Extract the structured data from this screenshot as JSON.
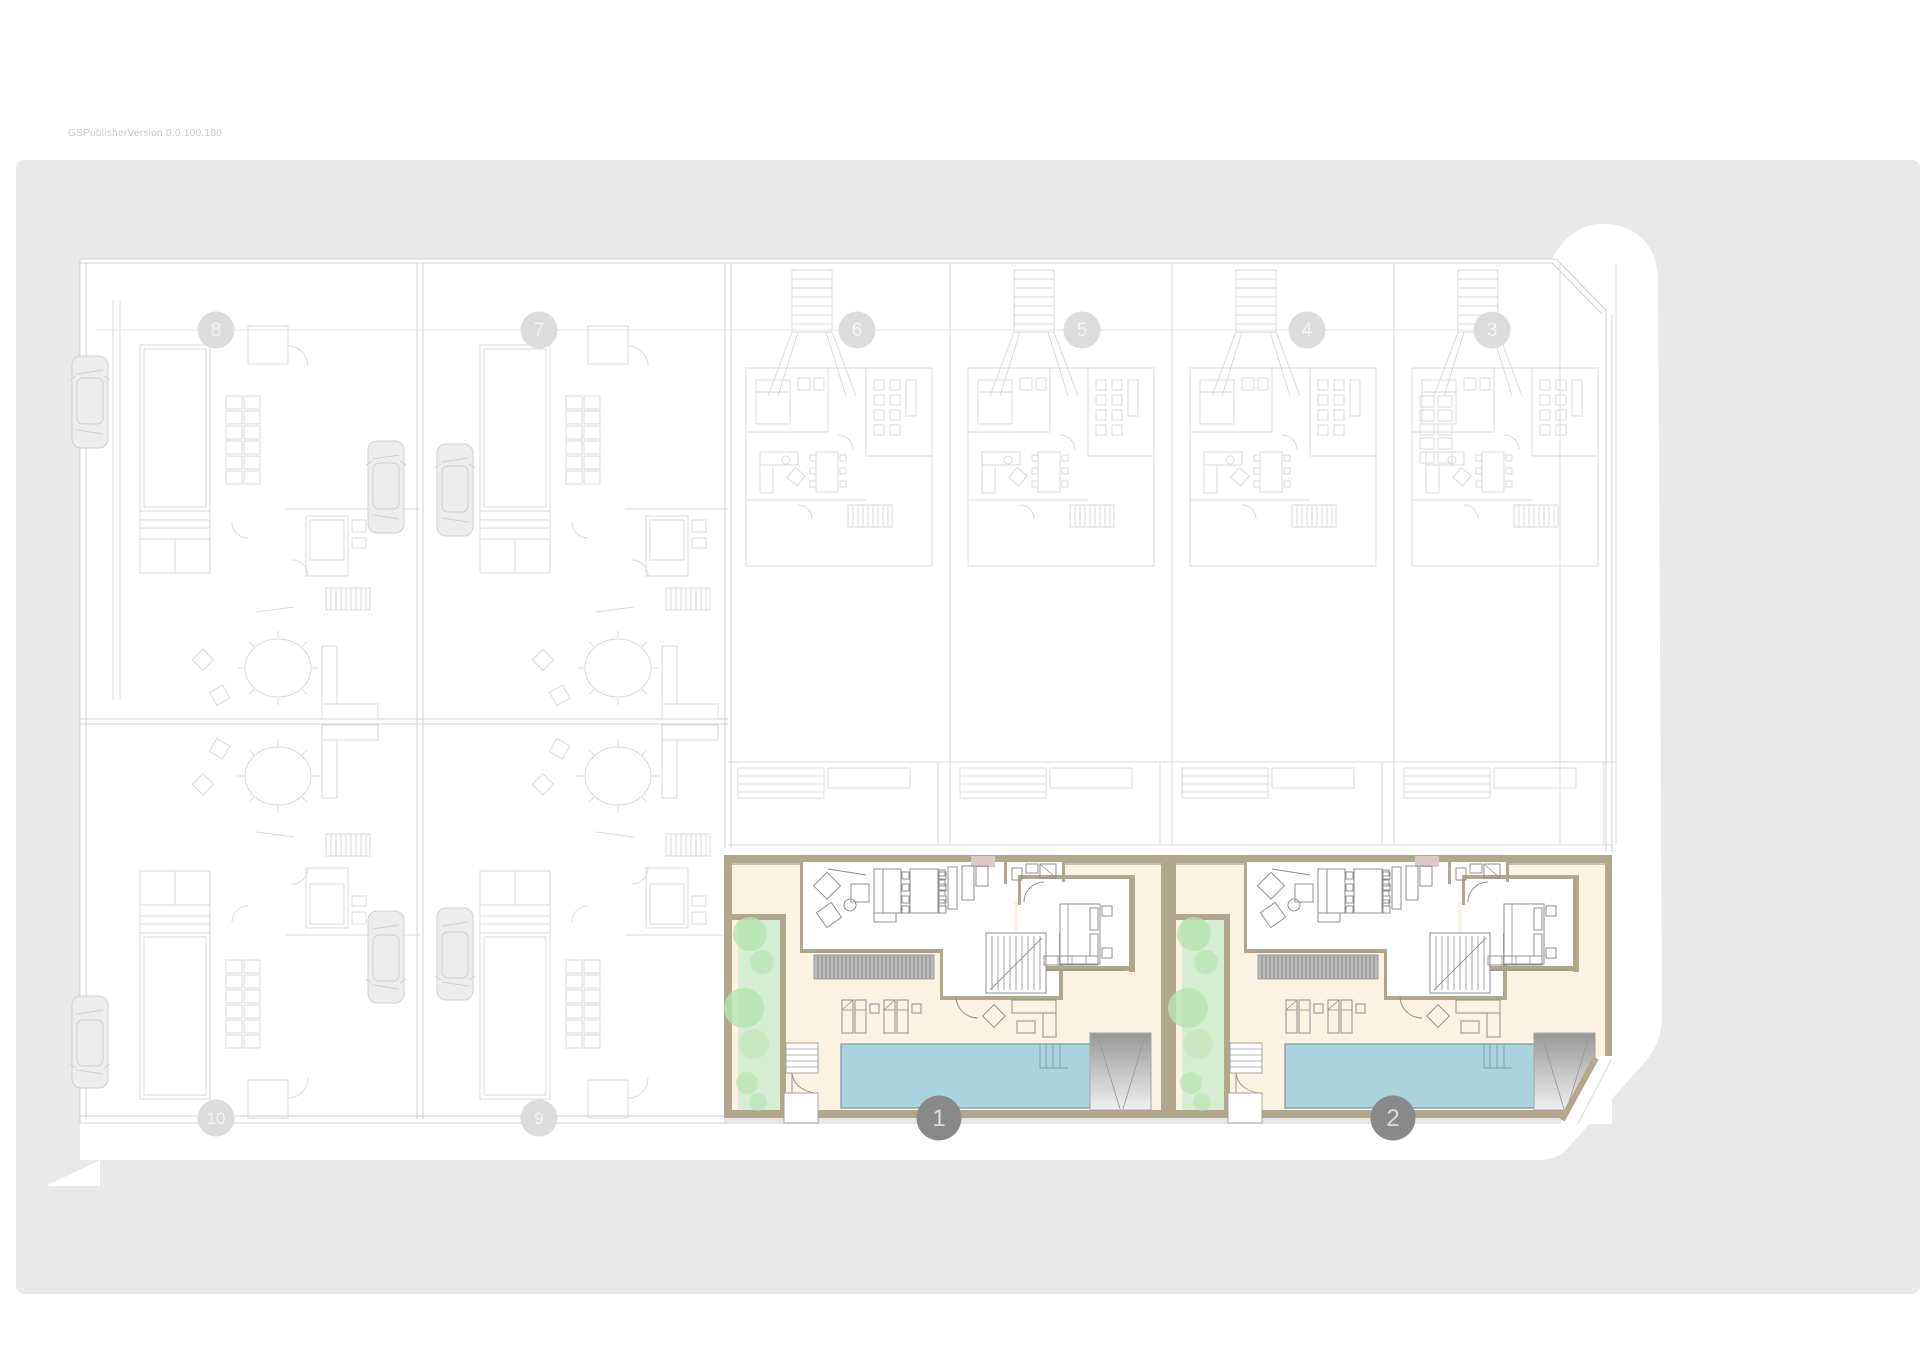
{
  "watermark": {
    "text": "GSPublisherVersion 0.0.100.100"
  },
  "colors": {
    "ground": "#e9e9e9",
    "parcel": "#ffffff",
    "ghost": "#d9d9d9",
    "ghost_strong": "#d0d0d0",
    "ghost_fill": "#ededed",
    "cream": "#fbf2e4",
    "wall_tan": "#b0a78c",
    "wall_shadow": "#a29a84",
    "room_wall": "#8e8e8e",
    "furniture": "#8f8f8f",
    "garden": "#d5edd2",
    "tree": "#b7e3b2",
    "pool": "#aad3de",
    "pool_edge": "#7f969d",
    "louver_fill": "#bcbcbc",
    "louver_line": "#808080",
    "mauve": "#dcc8c4",
    "ramp_dark": "#989898",
    "ramp_light": "#f0f0f0",
    "street_shadow": "#cdd2d4",
    "marker_dark": "#898989",
    "marker_dark_text": "#d9dde0",
    "marker_ghost": "#dcdcdc",
    "marker_ghost_text": "#f4f4f4"
  },
  "grid_markers": {
    "top_y": 330,
    "bottom_y": 1118,
    "radius": 18.5,
    "top": [
      {
        "label": "8",
        "x": 216
      },
      {
        "label": "7",
        "x": 539
      },
      {
        "label": "6",
        "x": 857
      },
      {
        "label": "5",
        "x": 1082
      },
      {
        "label": "4",
        "x": 1307
      },
      {
        "label": "3",
        "x": 1492
      }
    ],
    "bottom": [
      {
        "label": "10",
        "x": 216
      },
      {
        "label": "9",
        "x": 539
      }
    ]
  },
  "unit_markers": {
    "y": 1118,
    "radius": 22.5,
    "items": [
      {
        "label": "1",
        "x": 939
      },
      {
        "label": "2",
        "x": 1393
      }
    ]
  },
  "highlighted_units": [
    {
      "name": "unit-1",
      "x": 724,
      "chamfer": false
    },
    {
      "name": "unit-2",
      "x": 1168,
      "chamfer": true
    }
  ],
  "ghost_plots": {
    "middle_x": [
      728,
      950,
      1172
    ],
    "variant_x": 1394,
    "left_columns": [
      {
        "x": 80,
        "w": 340,
        "street_car": true
      },
      {
        "x": 420,
        "w": 308,
        "street_car": false
      }
    ]
  }
}
